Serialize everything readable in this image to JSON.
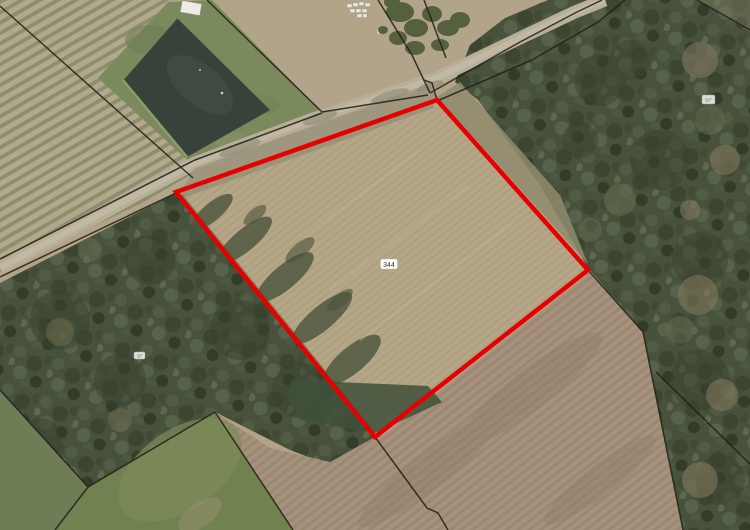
{
  "map": {
    "type": "aerial-orthophoto-cadastral-view",
    "parcel": {
      "label": "344",
      "outline_color": "#e60000"
    },
    "colors": {
      "bare_field": "#b5a687",
      "forest": "#48513c",
      "meadow": "#71814f",
      "pond": "#39423a",
      "road": "#b8af99",
      "cadastral_line": "#1f1f18"
    }
  }
}
